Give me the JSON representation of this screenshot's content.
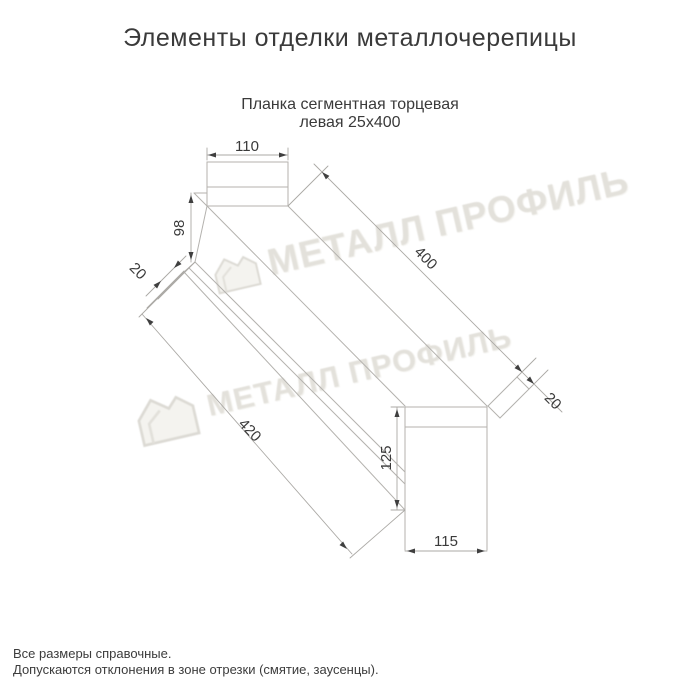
{
  "page": {
    "title": "Элементы отделки металлочерепицы"
  },
  "drawing": {
    "subtitle_line1": "Планка сегментная торцевая",
    "subtitle_line2": "левая 25х400",
    "dimensions": {
      "top_width": "110",
      "left_height": "98",
      "left_flange": "20",
      "length_top": "400",
      "right_flange": "20",
      "length_bottom": "420",
      "right_height": "125",
      "right_width": "115"
    }
  },
  "watermark": {
    "text": "МЕТАЛЛ ПРОФИЛЬ",
    "logo": "metall-profil-house-logo",
    "color": "#e3e1db"
  },
  "notes": {
    "line1": "Все размеры справочные.",
    "line2": "Допускаются отклонения в зоне отрезки (смятие, заусенцы)."
  },
  "colors": {
    "text": "#3a3a3a",
    "outline": "#b4b2ae",
    "dimension_lines": "#aba9a5",
    "background": "#ffffff"
  }
}
